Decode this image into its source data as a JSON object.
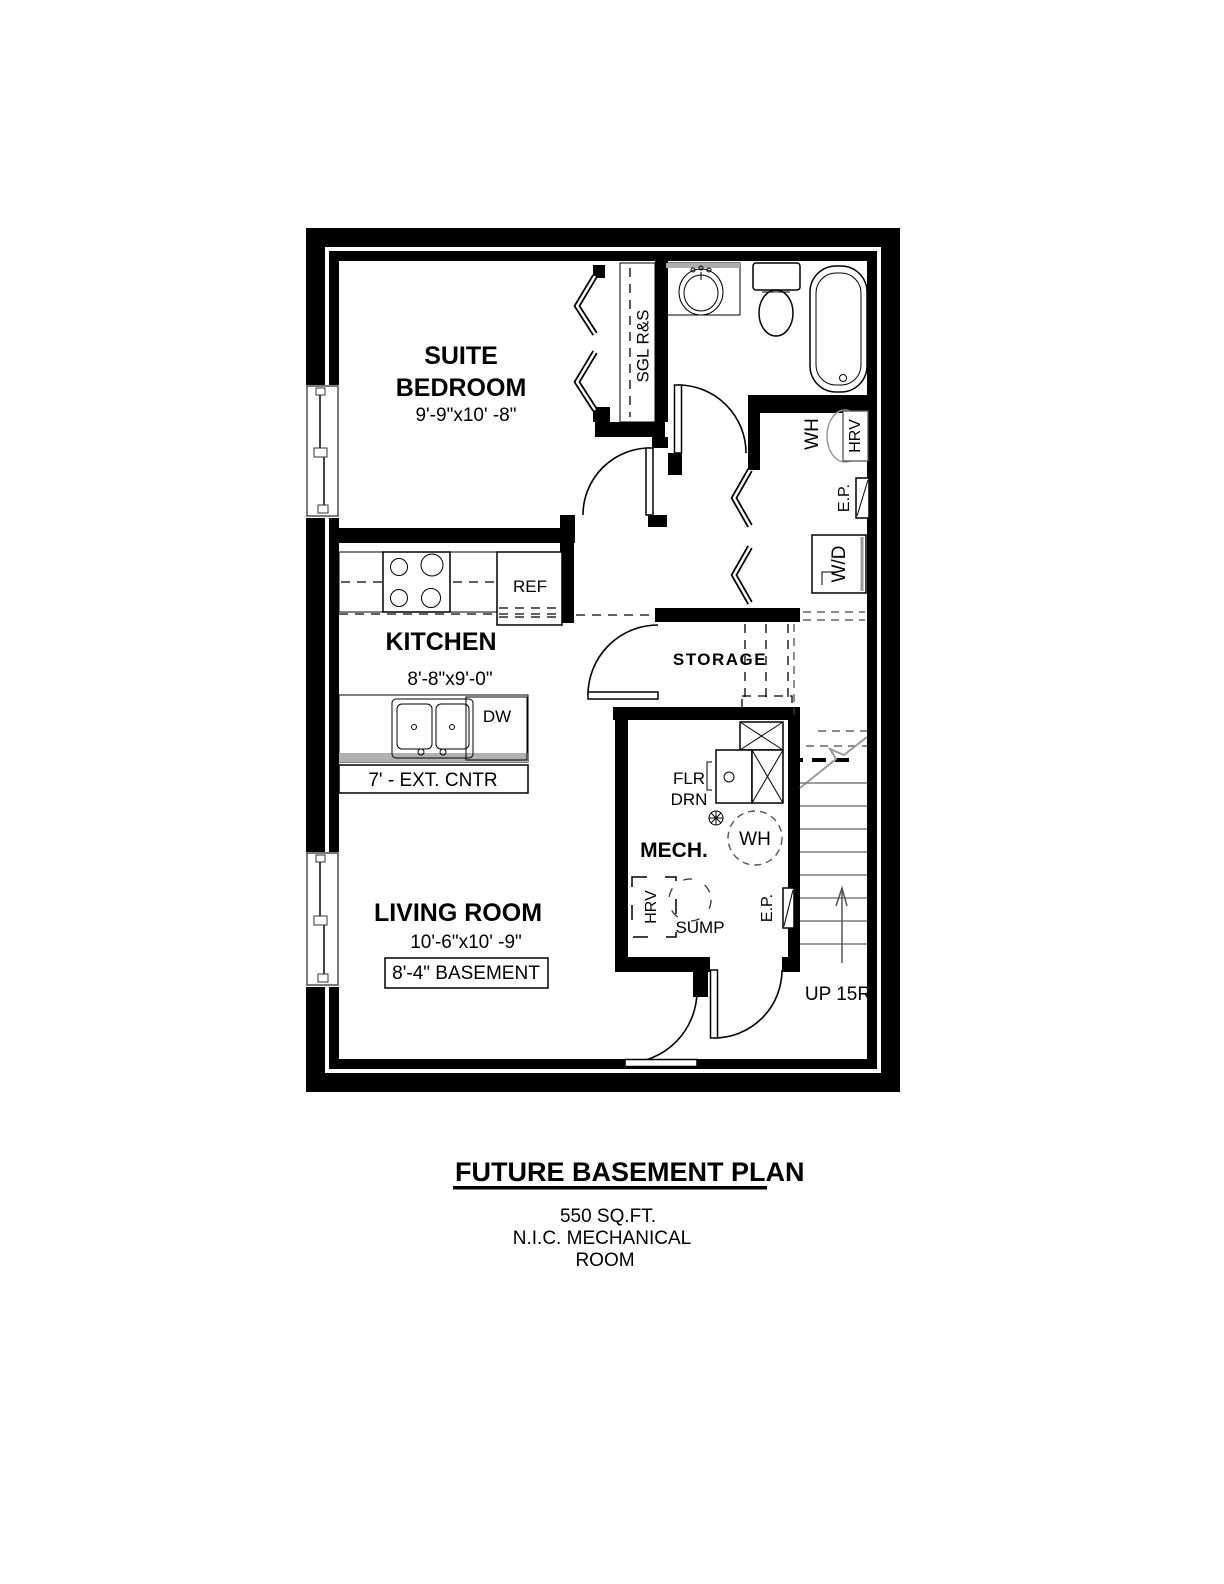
{
  "plan": {
    "rooms": {
      "suite_bedroom": {
        "line1": "SUITE",
        "line2": "BEDROOM",
        "dims": "9'-9\"x10' -8\""
      },
      "kitchen": {
        "name": "KITCHEN",
        "dims": "8'-8\"x9'-0\""
      },
      "living_room": {
        "name": "LIVING ROOM",
        "dims": "10'-6\"x10' -9\"",
        "ceiling_note": "8'-4\" BASEMENT"
      },
      "storage": {
        "name": "STORAGE"
      },
      "mech": {
        "name": "MECH."
      }
    },
    "fixtures": {
      "closet_rod": "SGL R&S",
      "fridge": "REF",
      "dishwasher": "DW",
      "counter": "7' - EXT. CNTR",
      "water_heater_upper": "WH",
      "hrv_upper": "HRV",
      "electrical_panel_upper": "E.P.",
      "washer_dryer": "W/D",
      "floor_drain_line1": "FLR",
      "floor_drain_line2": "DRN",
      "water_heater_mech": "WH",
      "hrv_mech": "HRV",
      "sump": "SUMP",
      "electrical_panel_mech": "E.P.",
      "stairs": "UP 15R"
    },
    "colors": {
      "wall": "#000000",
      "counter_shade": "#b0b0b0"
    }
  },
  "title_block": {
    "title": "FUTURE BASEMENT PLAN",
    "area": "550 SQ.FT.",
    "note_line1": "N.I.C. MECHANICAL",
    "note_line2": "ROOM"
  }
}
